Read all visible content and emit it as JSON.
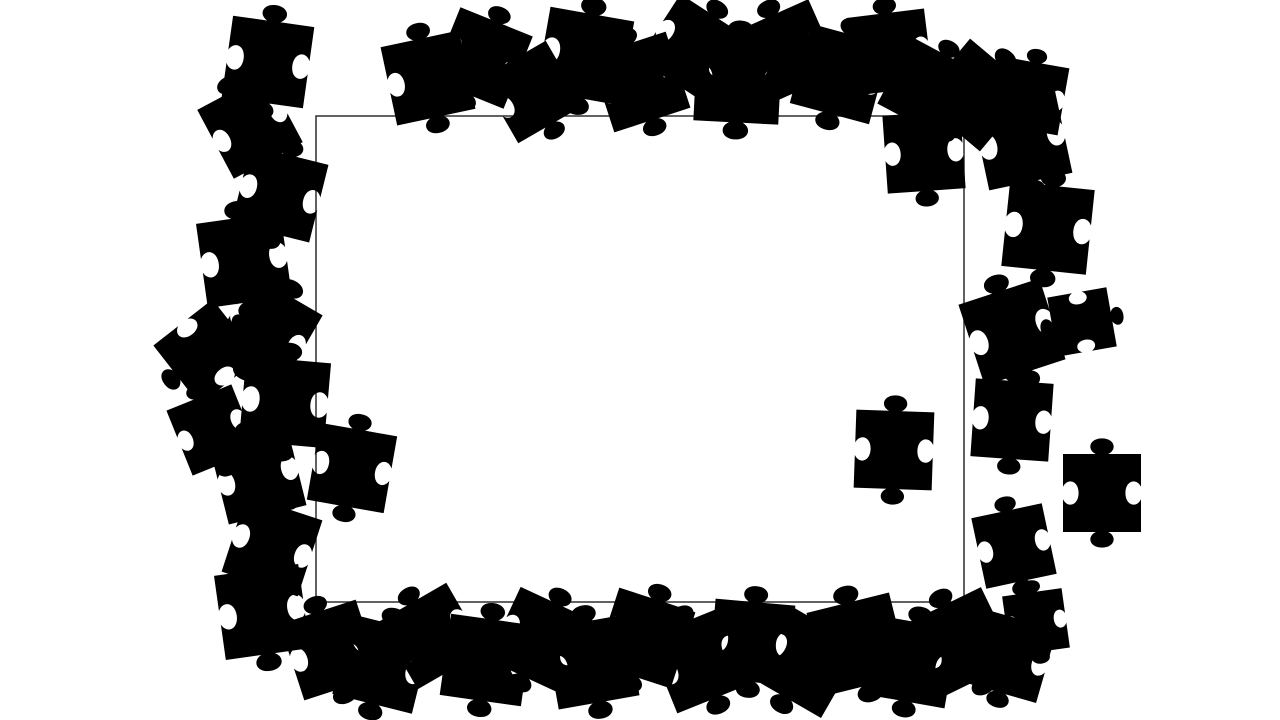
{
  "scene": {
    "background_color": "#ffffff",
    "piece_color": "#000000"
  },
  "board": {
    "x": 316,
    "y": 116,
    "width": 648,
    "height": 486,
    "fill": "#ffffff",
    "stroke_color": "#1f1f1f",
    "stroke_width": 1.4
  },
  "pieces": [
    {
      "x": 268,
      "y": 62,
      "r": 8,
      "s": 0.82
    },
    {
      "x": 250,
      "y": 126,
      "r": -28,
      "s": 0.78
    },
    {
      "x": 280,
      "y": 194,
      "r": 14,
      "s": 0.8
    },
    {
      "x": 244,
      "y": 260,
      "r": -8,
      "s": 0.85
    },
    {
      "x": 268,
      "y": 330,
      "r": 30,
      "s": 0.8
    },
    {
      "x": 206,
      "y": 352,
      "r": 52,
      "s": 0.75
    },
    {
      "x": 212,
      "y": 430,
      "r": -22,
      "s": 0.7
    },
    {
      "x": 285,
      "y": 402,
      "r": 5,
      "s": 0.85
    },
    {
      "x": 258,
      "y": 476,
      "r": -14,
      "s": 0.8
    },
    {
      "x": 272,
      "y": 546,
      "r": 18,
      "s": 0.8
    },
    {
      "x": 262,
      "y": 612,
      "r": -8,
      "s": 0.85
    },
    {
      "x": 352,
      "y": 468,
      "r": 10,
      "s": 0.78
    },
    {
      "x": 428,
      "y": 78,
      "r": -12,
      "s": 0.8
    },
    {
      "x": 482,
      "y": 58,
      "r": 22,
      "s": 0.78
    },
    {
      "x": 532,
      "y": 92,
      "r": -30,
      "s": 0.75
    },
    {
      "x": 585,
      "y": 56,
      "r": 10,
      "s": 0.85
    },
    {
      "x": 640,
      "y": 82,
      "r": -18,
      "s": 0.8
    },
    {
      "x": 692,
      "y": 48,
      "r": 33,
      "s": 0.78
    },
    {
      "x": 738,
      "y": 80,
      "r": 3,
      "s": 0.85
    },
    {
      "x": 788,
      "y": 52,
      "r": -24,
      "s": 0.8
    },
    {
      "x": 840,
      "y": 74,
      "r": 15,
      "s": 0.82
    },
    {
      "x": 890,
      "y": 52,
      "r": -7,
      "s": 0.78
    },
    {
      "x": 928,
      "y": 88,
      "r": 28,
      "s": 0.75
    },
    {
      "x": 975,
      "y": 95,
      "r": 40,
      "s": 0.8
    },
    {
      "x": 1022,
      "y": 140,
      "r": -12,
      "s": 0.85
    },
    {
      "x": 1030,
      "y": 96,
      "r": 10,
      "s": 0.68
    },
    {
      "x": 1048,
      "y": 228,
      "r": 6,
      "s": 0.85
    },
    {
      "x": 924,
      "y": 152,
      "r": -4,
      "s": 0.78
    },
    {
      "x": 1012,
      "y": 332,
      "r": -18,
      "s": 0.85
    },
    {
      "x": 1082,
      "y": 322,
      "r": 80,
      "s": 0.6
    },
    {
      "x": 1012,
      "y": 420,
      "r": 4,
      "s": 0.78
    },
    {
      "x": 1102,
      "y": 493,
      "r": 0,
      "s": 0.78
    },
    {
      "x": 1014,
      "y": 546,
      "r": -12,
      "s": 0.72
    },
    {
      "x": 894,
      "y": 450,
      "r": 2,
      "s": 0.78
    },
    {
      "x": 330,
      "y": 650,
      "r": -18,
      "s": 0.8
    },
    {
      "x": 382,
      "y": 664,
      "r": 14,
      "s": 0.82
    },
    {
      "x": 432,
      "y": 636,
      "r": -30,
      "s": 0.78
    },
    {
      "x": 486,
      "y": 660,
      "r": 8,
      "s": 0.82
    },
    {
      "x": 540,
      "y": 640,
      "r": 25,
      "s": 0.8
    },
    {
      "x": 592,
      "y": 662,
      "r": -10,
      "s": 0.82
    },
    {
      "x": 645,
      "y": 638,
      "r": 18,
      "s": 0.8
    },
    {
      "x": 700,
      "y": 660,
      "r": -22,
      "s": 0.82
    },
    {
      "x": 752,
      "y": 642,
      "r": 5,
      "s": 0.8
    },
    {
      "x": 806,
      "y": 662,
      "r": 30,
      "s": 0.82
    },
    {
      "x": 858,
      "y": 644,
      "r": -14,
      "s": 0.85
    },
    {
      "x": 912,
      "y": 662,
      "r": 10,
      "s": 0.8
    },
    {
      "x": 962,
      "y": 642,
      "r": -26,
      "s": 0.82
    },
    {
      "x": 1010,
      "y": 656,
      "r": 16,
      "s": 0.76
    },
    {
      "x": 1036,
      "y": 622,
      "r": -8,
      "s": 0.6
    }
  ]
}
